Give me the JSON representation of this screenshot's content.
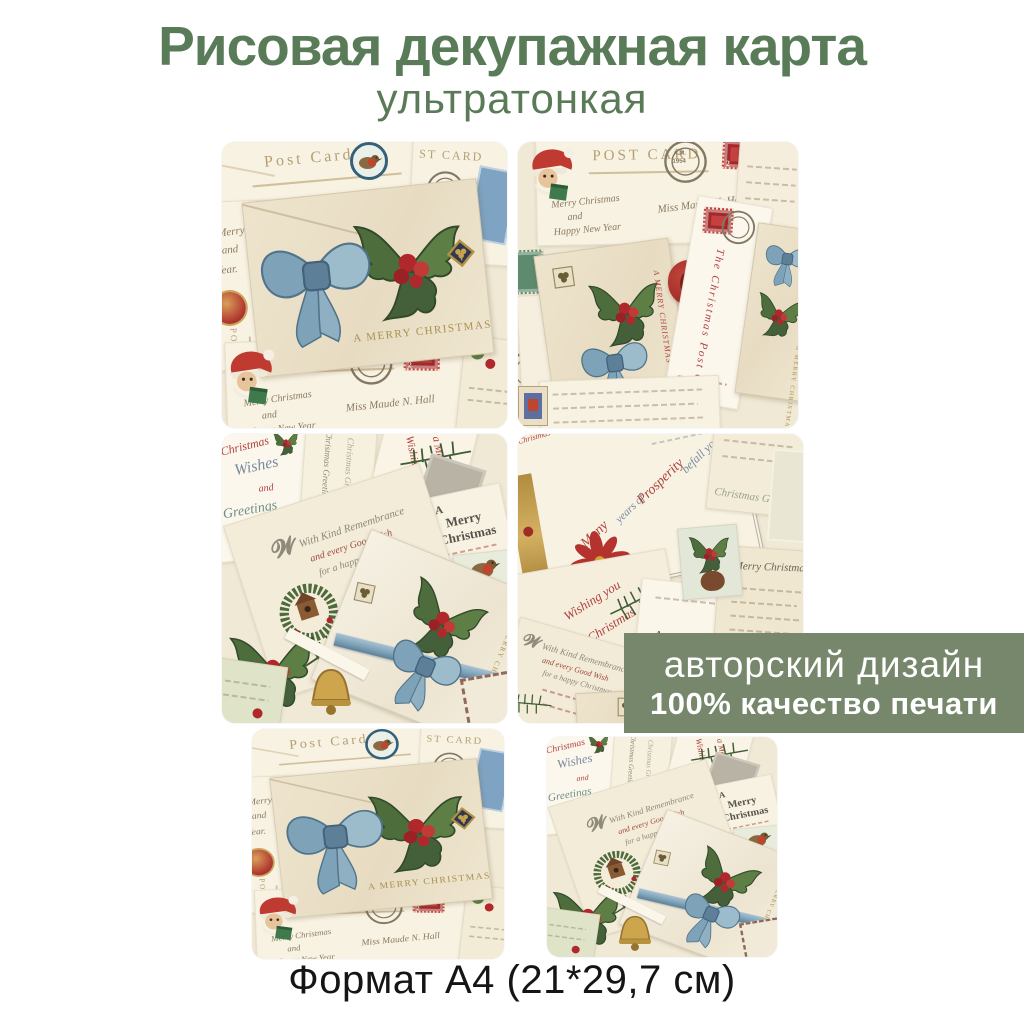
{
  "header": {
    "title": "Рисовая декупажная карта",
    "subtitle": "ультратонкая",
    "title_color": "#597b58"
  },
  "badge": {
    "line1": "авторский дизайн",
    "line2": "100% качество печати",
    "background": "#76876b",
    "text_color": "#ffffff"
  },
  "footer": {
    "format": "Формат А4 (21*29,7 см)"
  },
  "art": {
    "post_card": "Post Card",
    "post_card_caps": "POST CARD",
    "st_card": "ST CARD",
    "merry_christmas_caps": "A MERRY CHRISTMAS",
    "postmark_am": "A.M.",
    "postmark_year": "1954",
    "stamp_value": "2",
    "vertical_post": "POST CARD",
    "vertical_post_dash": "POST —",
    "hw": {
      "merry": "Merry Christmas",
      "and": "and",
      "happy": "Happy New Year",
      "year": "Year.",
      "maude": "Miss Maude N. Hall"
    },
    "wishes": {
      "l1": "Christmas",
      "l2": "Wishes",
      "l3": "and",
      "l4": "Greetings"
    },
    "greetings_script": "Christmas Greetings",
    "wishing": {
      "l1": "Wishing you",
      "l2": "a Merry Christmas"
    },
    "amc": {
      "a": "A",
      "merry": "Merry",
      "christmas": "Christmas"
    },
    "remembrance": {
      "l1": "With Kind Remembrance",
      "l2": "and every Good Wish",
      "l3": "for a happy Christmas"
    },
    "prosperity": {
      "l1": "Many",
      "l2": "years of",
      "l3": "Prosperity",
      "l4": "befall you"
    },
    "vertical_card": "The Christmas Post Card",
    "merry_note": "Merry Christmas"
  }
}
